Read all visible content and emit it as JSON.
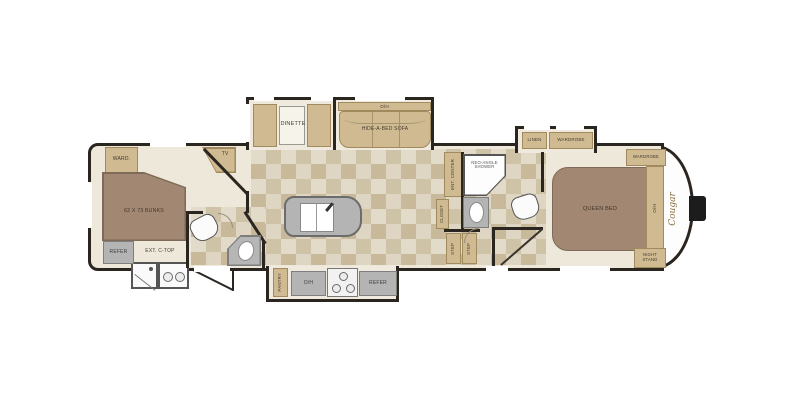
{
  "brand": {
    "logo": "Cougar"
  },
  "labels": {
    "ward": "WARD.",
    "tv": "TV",
    "bunks": "62 X 73 BUNKS",
    "refer": "REFER",
    "ext_ctop": "EXT. C-TOP",
    "dinette": "DINETTE",
    "oh": "O/H",
    "sofa": "HIDE-A-BED SOFA",
    "pantry": "PANTRY",
    "ent_center": "ENT. CENTER",
    "closet": "CLOSET",
    "shower_line1": "NEO-ANGLE",
    "shower_line2": "SHOWER",
    "step": "STEP",
    "linen": "LINEN",
    "wardrobe": "WARDROBE",
    "queen_bed": "QUEEN BED",
    "night_stand_line1": "NIGHT",
    "night_stand_line2": "STAND"
  },
  "colors": {
    "wall": "#2b2520",
    "cabinet": "#cfba91",
    "cabinet_border": "#a08a5e",
    "bed": "#a28772",
    "bed_border": "#7e6a58",
    "appliance": "#b4b4b4",
    "appliance_border": "#7e7e7e",
    "carpet": "#ede8d9",
    "slide_floor": "#efeadd",
    "tile_a": "#cfc3a7",
    "tile_b": "#ded5c2",
    "tile_c": "#c8b99b",
    "tile_d": "#e3dbca",
    "logo": "#8a6d3f",
    "label": "#443c30"
  }
}
